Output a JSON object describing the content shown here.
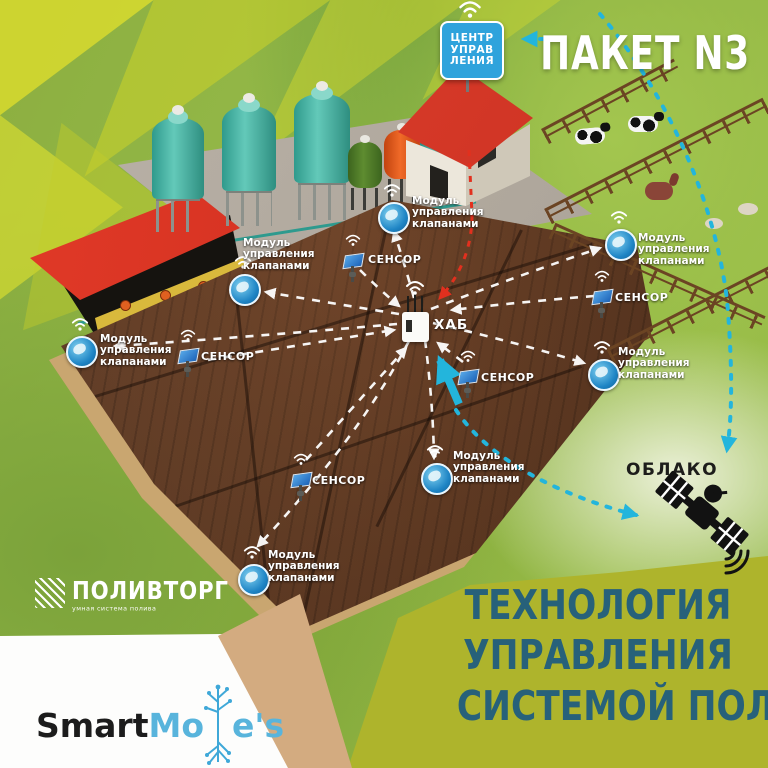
{
  "header": {
    "package_label": "ПАКЕТ N3",
    "control_center_lines": [
      "ЦЕНТР",
      "УПРАВ",
      "ЛЕНИЯ"
    ]
  },
  "diagram": {
    "hub_label": "ХАБ",
    "cloud_label": "ОБЛАКО",
    "module_label_lines": [
      "Модуль",
      "управления",
      "клапанами"
    ],
    "sensor_label": "СЕНСОР",
    "modules": [
      {
        "x": 378,
        "y": 202,
        "label_dx": 34,
        "label_dy": -6
      },
      {
        "x": 229,
        "y": 274,
        "label_dx": 14,
        "label_dy": -36
      },
      {
        "x": 66,
        "y": 336,
        "label_dx": 34,
        "label_dy": -2
      },
      {
        "x": 605,
        "y": 229,
        "label_dx": 33,
        "label_dy": 4
      },
      {
        "x": 588,
        "y": 359,
        "label_dx": 30,
        "label_dy": -12
      },
      {
        "x": 421,
        "y": 463,
        "label_dx": 32,
        "label_dy": -12
      },
      {
        "x": 238,
        "y": 564,
        "label_dx": 30,
        "label_dy": -14
      }
    ],
    "sensors": [
      {
        "x": 344,
        "y": 248,
        "label_dx": 24,
        "label_dy": 6
      },
      {
        "x": 179,
        "y": 343,
        "label_dx": 22,
        "label_dy": 8
      },
      {
        "x": 593,
        "y": 284,
        "label_dx": 22,
        "label_dy": 8
      },
      {
        "x": 459,
        "y": 364,
        "label_dx": 22,
        "label_dy": 8
      },
      {
        "x": 292,
        "y": 467,
        "label_dx": 20,
        "label_dy": 8
      }
    ]
  },
  "footer": {
    "brand_polivtorg": {
      "name": "ПОЛИВТОРГ",
      "tagline": "умная система полива"
    },
    "brand_smartmoles": {
      "part1": "Smart",
      "part2": "Mo",
      "part3": "e's"
    },
    "title_lines": [
      "ТЕХНОЛОГИЯ",
      "УПРАВЛЕНИЯ",
      "СИСТЕМОЙ ПОЛИВА"
    ]
  },
  "colors": {
    "accent_cyan": "#23b5dc",
    "alert_red": "#e2301e",
    "title_teal": "#27617a",
    "block_yellow": "#aeb42c",
    "sign_blue": "#2fa3dc"
  }
}
